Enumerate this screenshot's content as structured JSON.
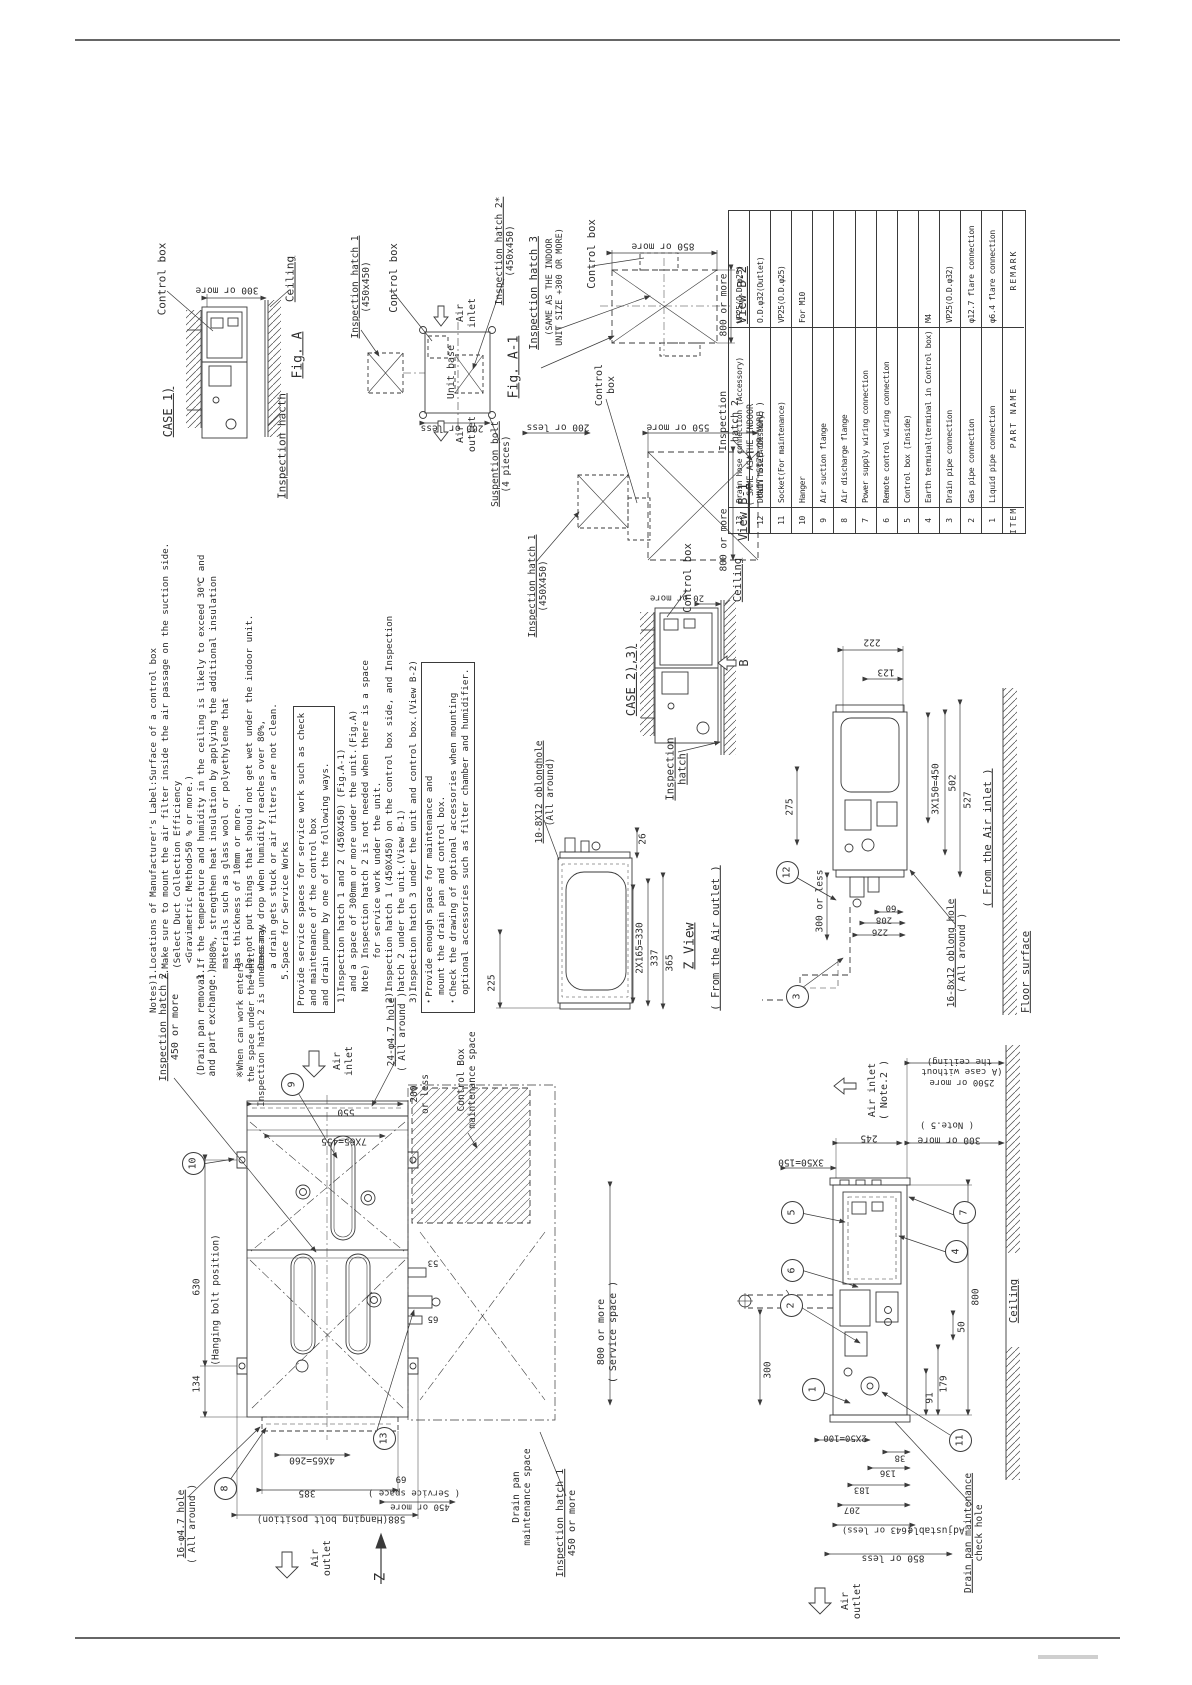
{
  "sheet": {
    "width": 1192,
    "height": 1685
  },
  "parts_table": {
    "header": [
      "ITEM",
      "PART NAME",
      "REMARK"
    ],
    "rows": [
      [
        "13",
        "Drain hose connection (Accessory)",
        "VP25(O.D.φ25)"
      ],
      [
        "12",
        "Drain hose(Accessory)",
        "O.D.φ32(Outlet)"
      ],
      [
        "11",
        "Socket(For maintenance)",
        "VP25(O.D.φ25)"
      ],
      [
        "10",
        "Hanger",
        "For M10"
      ],
      [
        "9",
        "Air suction flange",
        ""
      ],
      [
        "8",
        "Air discharge flange",
        ""
      ],
      [
        "7",
        "Power supply wiring connection",
        ""
      ],
      [
        "6",
        "Remote control wiring connection",
        ""
      ],
      [
        "5",
        "Control box (Inside)",
        ""
      ],
      [
        "4",
        "Earth terminal(terminal in Control box)",
        "M4"
      ],
      [
        "3",
        "Drain pipe connection",
        "VP25(O.D.φ32)"
      ],
      [
        "2",
        "Gas pipe connection",
        "φ12.7 flare connection"
      ],
      [
        "1",
        "Liquid pipe connection",
        "φ6.4 flare connection"
      ]
    ]
  },
  "notes": {
    "lines": [
      "Notes)1.Locations of Manufacturer's Label:Surface of a control box",
      "      2.Make sure to mount the air filter inside the air passage on the suction side.",
      "        (Select Duct Collection Efficiency",
      "         <Gravimetric Method>50 % or more.)",
      "      3.If the temperature and humidity in the ceiling is likely to exceed 30℃ and",
      "        RH80%, strengthen heat insulation by applying the additional insulation",
      "        materials such as glass wool or polyethylene that",
      "        has thickness of 10mm or more.",
      "      4.Do not put things that should not get wet under the indoor unit.",
      "        Dews may drop when humidity reaches over 80%,",
      "        a drain gets stuck or air filters are not clean.",
      "      5.Space for Service Works"
    ],
    "box1": [
      "Provide service spaces for service work such as check",
      "and maintenance of the control box",
      "and drain pump by one of the following ways."
    ],
    "list": [
      "1)Inspection hatch 1 and 2 (450X450) (Fig.A-1)",
      "  and a space of 300mm or more under the unit.(Fig.A)",
      "  Note) Inspection hatch 2 is not needed when there is a space",
      "        for service work under the unit.",
      "2)Inspection hatch 1 (450X450) on the control box side, and Inspection",
      "  hatch 2 under the unit.(View B-1)",
      "3)Inspection hatch 3 under the unit and control box.(View B-2)"
    ],
    "box2": [
      "・Provide enough space for maintenance and",
      "  mount the drain pan and control box.",
      "・Check the drawing of optional accessories when mounting",
      "  optional accessories such as filter chamber and humidifier."
    ]
  },
  "labels": [
    {
      "n": "control-box-label-case1",
      "t": "Control box",
      "x": 163,
      "y": 279,
      "r": "v",
      "s": 11
    },
    {
      "n": "case1-title",
      "t": "CASE 1)",
      "x": 168,
      "y": 412,
      "r": "v",
      "s": 12,
      "u": "all"
    },
    {
      "n": "dim-300-or-more-case1",
      "t": "300 or more",
      "x": 227,
      "y": 290,
      "r": "u",
      "s": 9.5
    },
    {
      "n": "ceiling-label-case1",
      "t": "Ceiling",
      "x": 291,
      "y": 279,
      "r": "v",
      "s": 11,
      "u": "all"
    },
    {
      "n": "fig-a-title",
      "t": "Fig. A",
      "x": 298,
      "y": 355,
      "r": "v",
      "s": 13,
      "u": "all"
    },
    {
      "n": "inspection-hacth-label-case1",
      "t": "Inspection hacth",
      "x": 283,
      "y": 446,
      "r": "v",
      "s": 11,
      "u": "all"
    },
    {
      "n": "inspection-hatch1-figa1-label",
      "t": "Inspection hatch 1\n(450x450)",
      "x": 361,
      "y": 287,
      "r": "v",
      "s": 9.5,
      "u": "first"
    },
    {
      "n": "control-box-label-figa1",
      "t": "Control box",
      "x": 394,
      "y": 278,
      "r": "v",
      "s": 10.5
    },
    {
      "n": "air-inlet-label-figa1",
      "t": "Air\ninlet",
      "x": 467,
      "y": 313,
      "r": "v",
      "s": 10
    },
    {
      "n": "unit-base-label",
      "t": "Unit base",
      "x": 452,
      "y": 372,
      "r": "v",
      "s": 10
    },
    {
      "n": "air-outlet-label-figa1",
      "t": "Air\noutlet",
      "x": 467,
      "y": 434,
      "r": "v",
      "s": 10
    },
    {
      "n": "dim-200-or-less-figa1",
      "t": "200 or less",
      "x": 452,
      "y": 428,
      "r": "u",
      "s": 9.5
    },
    {
      "n": "suspention-bolt-label",
      "t": "Suspention bolt\n(4 pieces)",
      "x": 501,
      "y": 464,
      "r": "v",
      "s": 9.5,
      "u": "first"
    },
    {
      "n": "fig-a1-title",
      "t": "Fig. A-1",
      "x": 514,
      "y": 367,
      "r": "v",
      "s": 13,
      "u": "all"
    },
    {
      "n": "inspection-hatch2-star-label",
      "t": "Inspection hatch 2*\n(450x450)",
      "x": 505,
      "y": 251,
      "r": "v",
      "s": 9.5,
      "u": "first"
    },
    {
      "n": "inspection-hatch3-label",
      "t": "Inspection hatch 3",
      "x": 534,
      "y": 293,
      "r": "v",
      "s": 10.5,
      "u": "all"
    },
    {
      "n": "hatch3-same-note",
      "t": "(SAME AS THE INDOOR\nUNIT SIZE +300 OR MORE)",
      "x": 555,
      "y": 287,
      "r": "v",
      "s": 8.5
    },
    {
      "n": "control-box-label-viewb2",
      "t": "Control box",
      "x": 592,
      "y": 254,
      "r": "v",
      "s": 10.5
    },
    {
      "n": "dim-850-or-more",
      "t": "850 or more",
      "x": 663,
      "y": 246,
      "r": "u",
      "s": 9.5
    },
    {
      "n": "dim-800-or-more-b2",
      "t": "800 or more",
      "x": 724,
      "y": 305,
      "r": "v",
      "s": 9.5
    },
    {
      "n": "view-b2-title",
      "t": "View B-2",
      "x": 742,
      "y": 295,
      "r": "v",
      "s": 12,
      "u": "all"
    },
    {
      "n": "control-box-label-viewb1",
      "t": "Control\nbox",
      "x": 606,
      "y": 385,
      "r": "v",
      "s": 10
    },
    {
      "n": "dim-200-or-less-b1",
      "t": "200 or less",
      "x": 558,
      "y": 427,
      "r": "u",
      "s": 9.5
    },
    {
      "n": "dim-550-or-more",
      "t": "550 or more",
      "x": 678,
      "y": 427,
      "r": "u",
      "s": 9.5
    },
    {
      "n": "inspection-hatch2-label-b1",
      "t": "Inspection\nhatch 2",
      "x": 730,
      "y": 421,
      "r": "v",
      "s": 10
    },
    {
      "n": "hatch2-same-note",
      "t": "( SAME AS THE INDOOR\n  UNIT SIZE OR MORE )",
      "x": 756,
      "y": 455,
      "r": "v",
      "s": 8.5
    },
    {
      "n": "dim-800-or-more-b1",
      "t": "800 or more",
      "x": 724,
      "y": 540,
      "r": "v",
      "s": 9.5
    },
    {
      "n": "view-b1-title",
      "t": "View B-1",
      "x": 743,
      "y": 512,
      "r": "v",
      "s": 12,
      "u": "all"
    },
    {
      "n": "inspection-hatch1-label-b1",
      "t": "Inspection hatch 1\n(450X450)",
      "x": 538,
      "y": 586,
      "r": "v",
      "s": 9.5,
      "u": "first"
    },
    {
      "n": "case23-title",
      "t": "CASE 2),3)",
      "x": 631,
      "y": 680,
      "r": "v",
      "s": 12,
      "u": "all"
    },
    {
      "n": "control-box-label-case23",
      "t": "Control box",
      "x": 688,
      "y": 578,
      "r": "v",
      "s": 10.5
    },
    {
      "n": "dim-20-or-more",
      "t": "20 or more",
      "x": 677,
      "y": 597,
      "r": "u",
      "s": 9
    },
    {
      "n": "ceiling-label-case23",
      "t": "Ceiling",
      "x": 738,
      "y": 580,
      "r": "v",
      "s": 10.5,
      "u": "all"
    },
    {
      "n": "view-b-arrow-label",
      "t": "B",
      "x": 744,
      "y": 663,
      "r": "v",
      "s": 12
    },
    {
      "n": "inspection-hatch-label-case23",
      "t": "Inspection\nhatch",
      "x": 677,
      "y": 769,
      "r": "v",
      "s": 10.5,
      "u": "all"
    },
    {
      "n": "oblong-hole-10-label",
      "t": "10-8X12 oblonghole\n(All around)",
      "x": 545,
      "y": 792,
      "r": "v",
      "s": 9.5,
      "u": "first"
    },
    {
      "n": "dim-26",
      "t": "26",
      "x": 643,
      "y": 839,
      "r": "v",
      "s": 9.5
    },
    {
      "n": "dim-225",
      "t": "225",
      "x": 492,
      "y": 983,
      "r": "v",
      "s": 9.5
    },
    {
      "n": "dim-2x165",
      "t": "2X165=330",
      "x": 640,
      "y": 948,
      "r": "v",
      "s": 9.5
    },
    {
      "n": "dim-337",
      "t": "337",
      "x": 655,
      "y": 958,
      "r": "v",
      "s": 9.5
    },
    {
      "n": "dim-365",
      "t": "365",
      "x": 670,
      "y": 963,
      "r": "v",
      "s": 9.5
    },
    {
      "n": "z-view-title",
      "t": "Z View",
      "x": 690,
      "y": 946,
      "r": "v",
      "s": 13,
      "u": "all"
    },
    {
      "n": "from-air-outlet-label",
      "t": "( From the Air outlet )",
      "x": 716,
      "y": 938,
      "r": "v",
      "s": 10.5,
      "u": "all"
    },
    {
      "n": "dim-222",
      "t": "222",
      "x": 872,
      "y": 642,
      "r": "u",
      "s": 9.5
    },
    {
      "n": "dim-123",
      "t": "123",
      "x": 886,
      "y": 672,
      "r": "u",
      "s": 9.5
    },
    {
      "n": "dim-275",
      "t": "275",
      "x": 790,
      "y": 807,
      "r": "v",
      "s": 9.5
    },
    {
      "n": "dim-3x150",
      "t": "3X150=450",
      "x": 936,
      "y": 789,
      "r": "v",
      "s": 9.5
    },
    {
      "n": "dim-502",
      "t": "502",
      "x": 953,
      "y": 783,
      "r": "v",
      "s": 9.5
    },
    {
      "n": "dim-527",
      "t": "527",
      "x": 968,
      "y": 800,
      "r": "v",
      "s": 9.5
    },
    {
      "n": "dim-300-or-less",
      "t": "300 or less",
      "x": 820,
      "y": 901,
      "r": "v",
      "s": 9.5
    },
    {
      "n": "dim-60",
      "t": "60",
      "x": 891,
      "y": 907,
      "r": "u",
      "s": 9
    },
    {
      "n": "dim-208",
      "t": "208",
      "x": 884,
      "y": 919,
      "r": "u",
      "s": 9
    },
    {
      "n": "dim-226",
      "t": "226",
      "x": 880,
      "y": 931,
      "r": "u",
      "s": 9
    },
    {
      "n": "oblong-hole-16-8x12-label",
      "t": "16-8x12 oblong hole\n( All around )",
      "x": 957,
      "y": 953,
      "r": "v",
      "s": 9.5,
      "u": "first"
    },
    {
      "n": "from-air-inlet-label",
      "t": "( From the Air inlet )",
      "x": 988,
      "y": 838,
      "r": "v",
      "s": 10.5,
      "u": "all"
    },
    {
      "n": "floor-surface-label",
      "t": "Floor surface",
      "x": 1026,
      "y": 972,
      "r": "v",
      "s": 10.5,
      "u": "all"
    },
    {
      "n": "inspection-hatch2-plan-label",
      "t": "Inspection hatch 2\n450 or more",
      "x": 170,
      "y": 1027,
      "r": "v",
      "s": 10,
      "u": "first"
    },
    {
      "n": "drain-pan-removal-note",
      "t": "(Drain pan removal\n and part exchange.)",
      "x": 207,
      "y": 1025,
      "r": "v",
      "s": 9.5
    },
    {
      "n": "worker-note",
      "t": "※When can work enters\n  the space under the unit,\n  Inspection hatch 2 is unnecessary.",
      "x": 252,
      "y": 1020,
      "r": "v",
      "s": 9
    },
    {
      "n": "air-inlet-label-plan",
      "t": "Air\ninlet",
      "x": 344,
      "y": 1061,
      "r": "v",
      "s": 10
    },
    {
      "n": "hole-24-label",
      "t": "24-φ4.7 hole\n( All around )",
      "x": 397,
      "y": 1032,
      "r": "v",
      "s": 9.5,
      "u": "first"
    },
    {
      "n": "dim-550",
      "t": "550",
      "x": 346,
      "y": 1112,
      "r": "u",
      "s": 9.5
    },
    {
      "n": "dim-7x65",
      "t": "7X65=455",
      "x": 344,
      "y": 1141,
      "r": "u",
      "s": 9.5
    },
    {
      "n": "dim-630",
      "t": "630",
      "x": 197,
      "y": 1287,
      "r": "v",
      "s": 9.5
    },
    {
      "n": "hanging-bolt-position-label",
      "t": "(Hanging bolt position)",
      "x": 216,
      "y": 1300,
      "r": "v",
      "s": 9.5
    },
    {
      "n": "dim-134",
      "t": "134",
      "x": 197,
      "y": 1384,
      "r": "v",
      "s": 9.5
    },
    {
      "n": "hole-16-label",
      "t": "16-φ4.7 hole\n( All around )",
      "x": 187,
      "y": 1524,
      "r": "v",
      "s": 9.5,
      "u": "first"
    },
    {
      "n": "dim-4x65",
      "t": "4X65=260",
      "x": 312,
      "y": 1460,
      "r": "u",
      "s": 9.5
    },
    {
      "n": "dim-385",
      "t": "385",
      "x": 307,
      "y": 1493,
      "r": "u",
      "s": 9.5
    },
    {
      "n": "dim-588",
      "t": "588(Hanging bolt position)",
      "x": 331,
      "y": 1519,
      "r": "u",
      "s": 9.5
    },
    {
      "n": "air-outlet-label-plan",
      "t": "Air\noutlet",
      "x": 322,
      "y": 1558,
      "r": "v",
      "s": 10
    },
    {
      "n": "z-arrow-label",
      "t": "Z",
      "x": 381,
      "y": 1577,
      "r": "v",
      "s": 14
    },
    {
      "n": "dim-200-or-less-plan",
      "t": "200\nor less",
      "x": 420,
      "y": 1094,
      "r": "v",
      "s": 9.5
    },
    {
      "n": "control-box-maintenance-label",
      "t": "Control Box\nmaintenance space",
      "x": 467,
      "y": 1080,
      "r": "v",
      "s": 9.5
    },
    {
      "n": "dim-800-service",
      "t": "800 or more\n( Service space )",
      "x": 608,
      "y": 1332,
      "r": "v",
      "s": 10
    },
    {
      "n": "dim-53",
      "t": "53",
      "x": 433,
      "y": 1262,
      "r": "u",
      "s": 9
    },
    {
      "n": "dim-65",
      "t": "65",
      "x": 433,
      "y": 1318,
      "r": "u",
      "s": 9
    },
    {
      "n": "dim-69",
      "t": "69",
      "x": 401,
      "y": 1478,
      "r": "u",
      "s": 9
    },
    {
      "n": "service-space-note",
      "t": "( Service space )",
      "x": 414,
      "y": 1492,
      "r": "u",
      "s": 9
    },
    {
      "n": "dim-450-or-more-plan",
      "t": "450 or more",
      "x": 420,
      "y": 1506,
      "r": "u",
      "s": 9
    },
    {
      "n": "drain-pan-maintenance-label",
      "t": "Drain pan\nmaintenance space",
      "x": 522,
      "y": 1497,
      "r": "v",
      "s": 9.5
    },
    {
      "n": "inspection-hatch1-plan-label",
      "t": "Inspection hatch 1\n450 or more",
      "x": 567,
      "y": 1523,
      "r": "v",
      "s": 10,
      "u": "first"
    },
    {
      "n": "air-inlet-label-side",
      "t": "Air inlet\n( Note.2 )",
      "x": 879,
      "y": 1090,
      "r": "v",
      "s": 10
    },
    {
      "n": "dim-2500",
      "t": "2500 or more\n(A case without\n the ceiling)",
      "x": 962,
      "y": 1071,
      "r": "u",
      "s": 9
    },
    {
      "n": "note5-label",
      "t": "( Note.5 )",
      "x": 947,
      "y": 1124,
      "r": "u",
      "s": 9
    },
    {
      "n": "dim-300-or-more-side",
      "t": "300 or more",
      "x": 949,
      "y": 1140,
      "r": "u",
      "s": 9.5
    },
    {
      "n": "dim-245",
      "t": "245",
      "x": 869,
      "y": 1138,
      "r": "u",
      "s": 9.5
    },
    {
      "n": "dim-3x50",
      "t": "3X50=150",
      "x": 801,
      "y": 1162,
      "r": "u",
      "s": 9.5
    },
    {
      "n": "dim-300-side",
      "t": "300",
      "x": 768,
      "y": 1370,
      "r": "v",
      "s": 9.5
    },
    {
      "n": "dim-800-side",
      "t": "800",
      "x": 976,
      "y": 1297,
      "r": "v",
      "s": 9.5
    },
    {
      "n": "dim-50",
      "t": "50",
      "x": 962,
      "y": 1327,
      "r": "v",
      "s": 9.5
    },
    {
      "n": "dim-179",
      "t": "179",
      "x": 944,
      "y": 1384,
      "r": "v",
      "s": 9.5
    },
    {
      "n": "dim-91",
      "t": "91",
      "x": 930,
      "y": 1398,
      "r": "v",
      "s": 9.5
    },
    {
      "n": "dim-38",
      "t": "38",
      "x": 900,
      "y": 1457,
      "r": "u",
      "s": 9
    },
    {
      "n": "dim-136",
      "t": "136",
      "x": 888,
      "y": 1472,
      "r": "u",
      "s": 9
    },
    {
      "n": "dim-2x50",
      "t": "2X50=100",
      "x": 845,
      "y": 1437,
      "r": "u",
      "s": 9
    },
    {
      "n": "dim-183",
      "t": "183",
      "x": 862,
      "y": 1489,
      "r": "u",
      "s": 9
    },
    {
      "n": "dim-207",
      "t": "207",
      "x": 852,
      "y": 1509,
      "r": "u",
      "s": 9
    },
    {
      "n": "dim-643-or-less",
      "t": "(643 or less)",
      "x": 877,
      "y": 1529,
      "r": "u",
      "s": 9
    },
    {
      "n": "adjustable-label",
      "t": "Adjustable",
      "x": 936,
      "y": 1530,
      "r": "u",
      "s": 9.5
    },
    {
      "n": "dim-850-or-less",
      "t": "850 or less",
      "x": 893,
      "y": 1558,
      "r": "u",
      "s": 9.5
    },
    {
      "n": "drain-pan-check-hole-label",
      "t": "Drain pan maintenance\ncheck hole",
      "x": 974,
      "y": 1533,
      "r": "v",
      "s": 9.5,
      "u": "first"
    },
    {
      "n": "ceiling-label-side",
      "t": "Ceiling",
      "x": 1014,
      "y": 1301,
      "r": "v",
      "s": 10.5,
      "u": "all"
    },
    {
      "n": "air-outlet-label-side",
      "t": "Air\noutlet",
      "x": 852,
      "y": 1601,
      "r": "v",
      "s": 10
    }
  ],
  "balloons": [
    {
      "n": "9",
      "x": 291,
      "y": 1083
    },
    {
      "n": "10",
      "x": 192,
      "y": 1162
    },
    {
      "n": "8",
      "x": 224,
      "y": 1487
    },
    {
      "n": "13",
      "x": 383,
      "y": 1437
    },
    {
      "n": "12",
      "x": 786,
      "y": 871
    },
    {
      "n": "3",
      "x": 796,
      "y": 995
    },
    {
      "n": "5",
      "x": 791,
      "y": 1211
    },
    {
      "n": "6",
      "x": 791,
      "y": 1269
    },
    {
      "n": "2",
      "x": 790,
      "y": 1304
    },
    {
      "n": "1",
      "x": 812,
      "y": 1388
    },
    {
      "n": "7",
      "x": 963,
      "y": 1211
    },
    {
      "n": "4",
      "x": 955,
      "y": 1250
    },
    {
      "n": "11",
      "x": 959,
      "y": 1439
    }
  ]
}
